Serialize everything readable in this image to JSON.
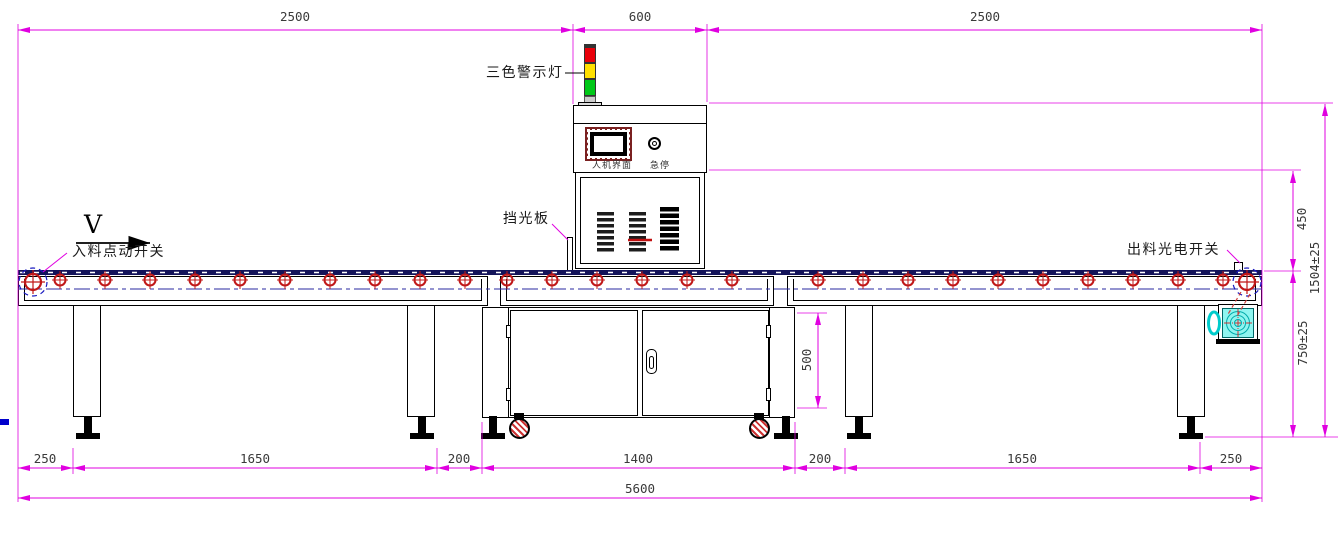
{
  "drawing": {
    "labels": {
      "warning_light": "三色警示灯",
      "light_shield": "挡光板",
      "infeed_jog_switch": "入料点动开关",
      "outfeed_photo_switch": "出料光电开关",
      "hmi_panel": "人机界面",
      "emergency_stop": "急停",
      "flow_direction": "V"
    },
    "dimensions": {
      "top": [
        "2500",
        "600",
        "2500"
      ],
      "bottom": [
        "250",
        "1650",
        "200",
        "1400",
        "200",
        "1650",
        "250"
      ],
      "total_length": "5600",
      "right_upper": "450",
      "right_lower": "750±25",
      "right_overall": "1504±25",
      "cabinet_height": "500"
    },
    "colors": {
      "dimension_line": "#e000e0",
      "roller_red": "#c01818",
      "centerline_blue": "#2828a0",
      "belt_navy": "#14145a",
      "tower_red": "#e8000a",
      "tower_yellow": "#ffe000",
      "tower_green": "#00c818",
      "motor_cyan": "#8ff5f0",
      "hmi_frame_maroon": "#7a2020"
    }
  }
}
